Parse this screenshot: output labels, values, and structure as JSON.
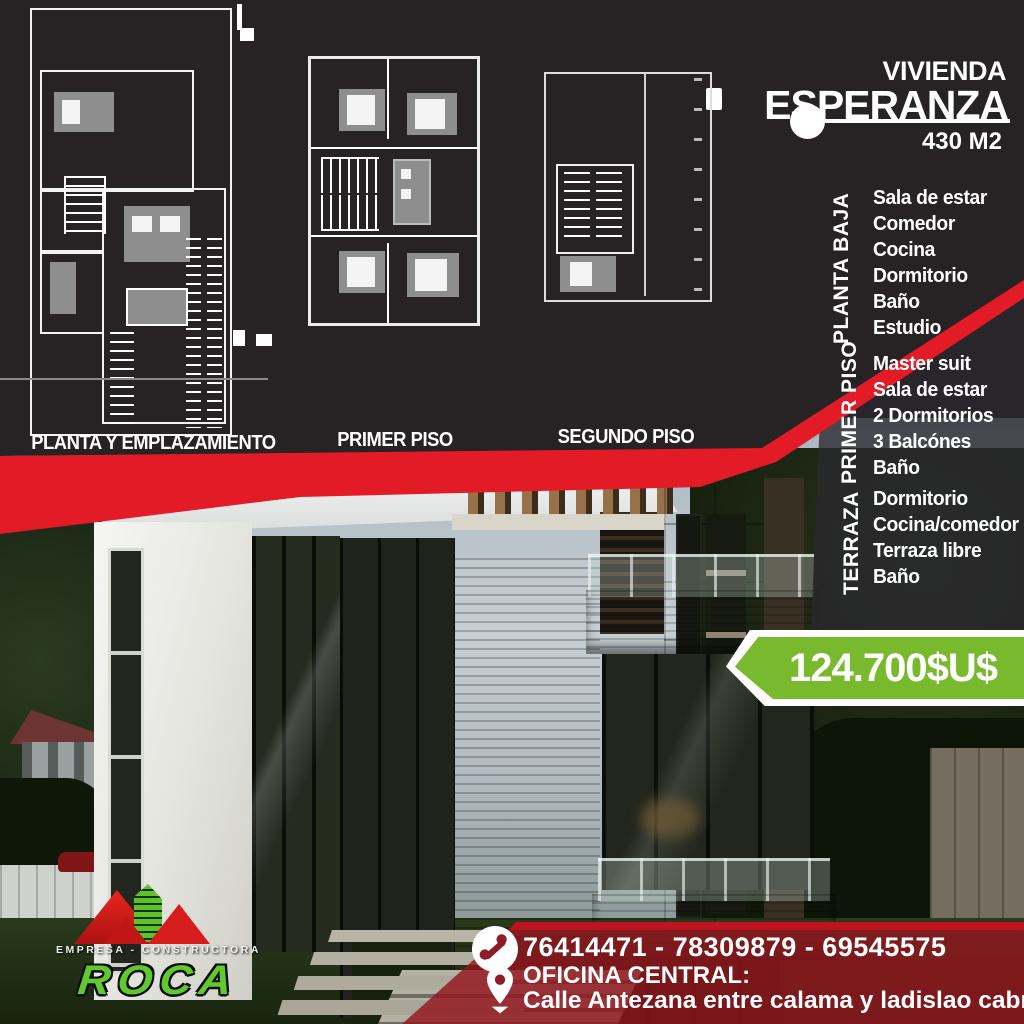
{
  "poster": {
    "title": {
      "line1": "VIVIENDA",
      "line2": "ESPERANZA",
      "area": "430 M2"
    },
    "plans": [
      {
        "label": "PLANTA Y EMPLAZAMIENTO"
      },
      {
        "label": "PRIMER PISO"
      },
      {
        "label": "SEGUNDO PISO"
      }
    ],
    "sections": [
      {
        "label": "PLANTA  BAJA",
        "items": [
          "Sala de estar",
          "Comedor",
          "Cocina",
          "Dormitorio",
          "Baño",
          "Estudio"
        ]
      },
      {
        "label": "PRIMER  PISO",
        "items": [
          "Master suit",
          "Sala de estar",
          "2 Dormitorios",
          "3 Balcónes",
          "Baño"
        ]
      },
      {
        "label": "TERRAZA",
        "items": [
          "Dormitorio",
          "Cocina/comedor",
          "Terraza libre",
          "Baño"
        ]
      }
    ],
    "price": "124.700$U$",
    "contact": {
      "phones": "76414471 - 78309879 - 69545575",
      "office_label": "OFICINA CENTRAL:",
      "address": "Calle Antezana entre calama y ladislao cabrera"
    },
    "logo": {
      "tagline": "EMPRESA - CONSTRUCTORA",
      "name": "ROCA"
    },
    "colors": {
      "accent_red": "#e21b26",
      "price_green": "#79b92d",
      "logo_green": "#5fc92d",
      "panel_dark": "#272324",
      "band_red": "#8e1b26"
    }
  }
}
